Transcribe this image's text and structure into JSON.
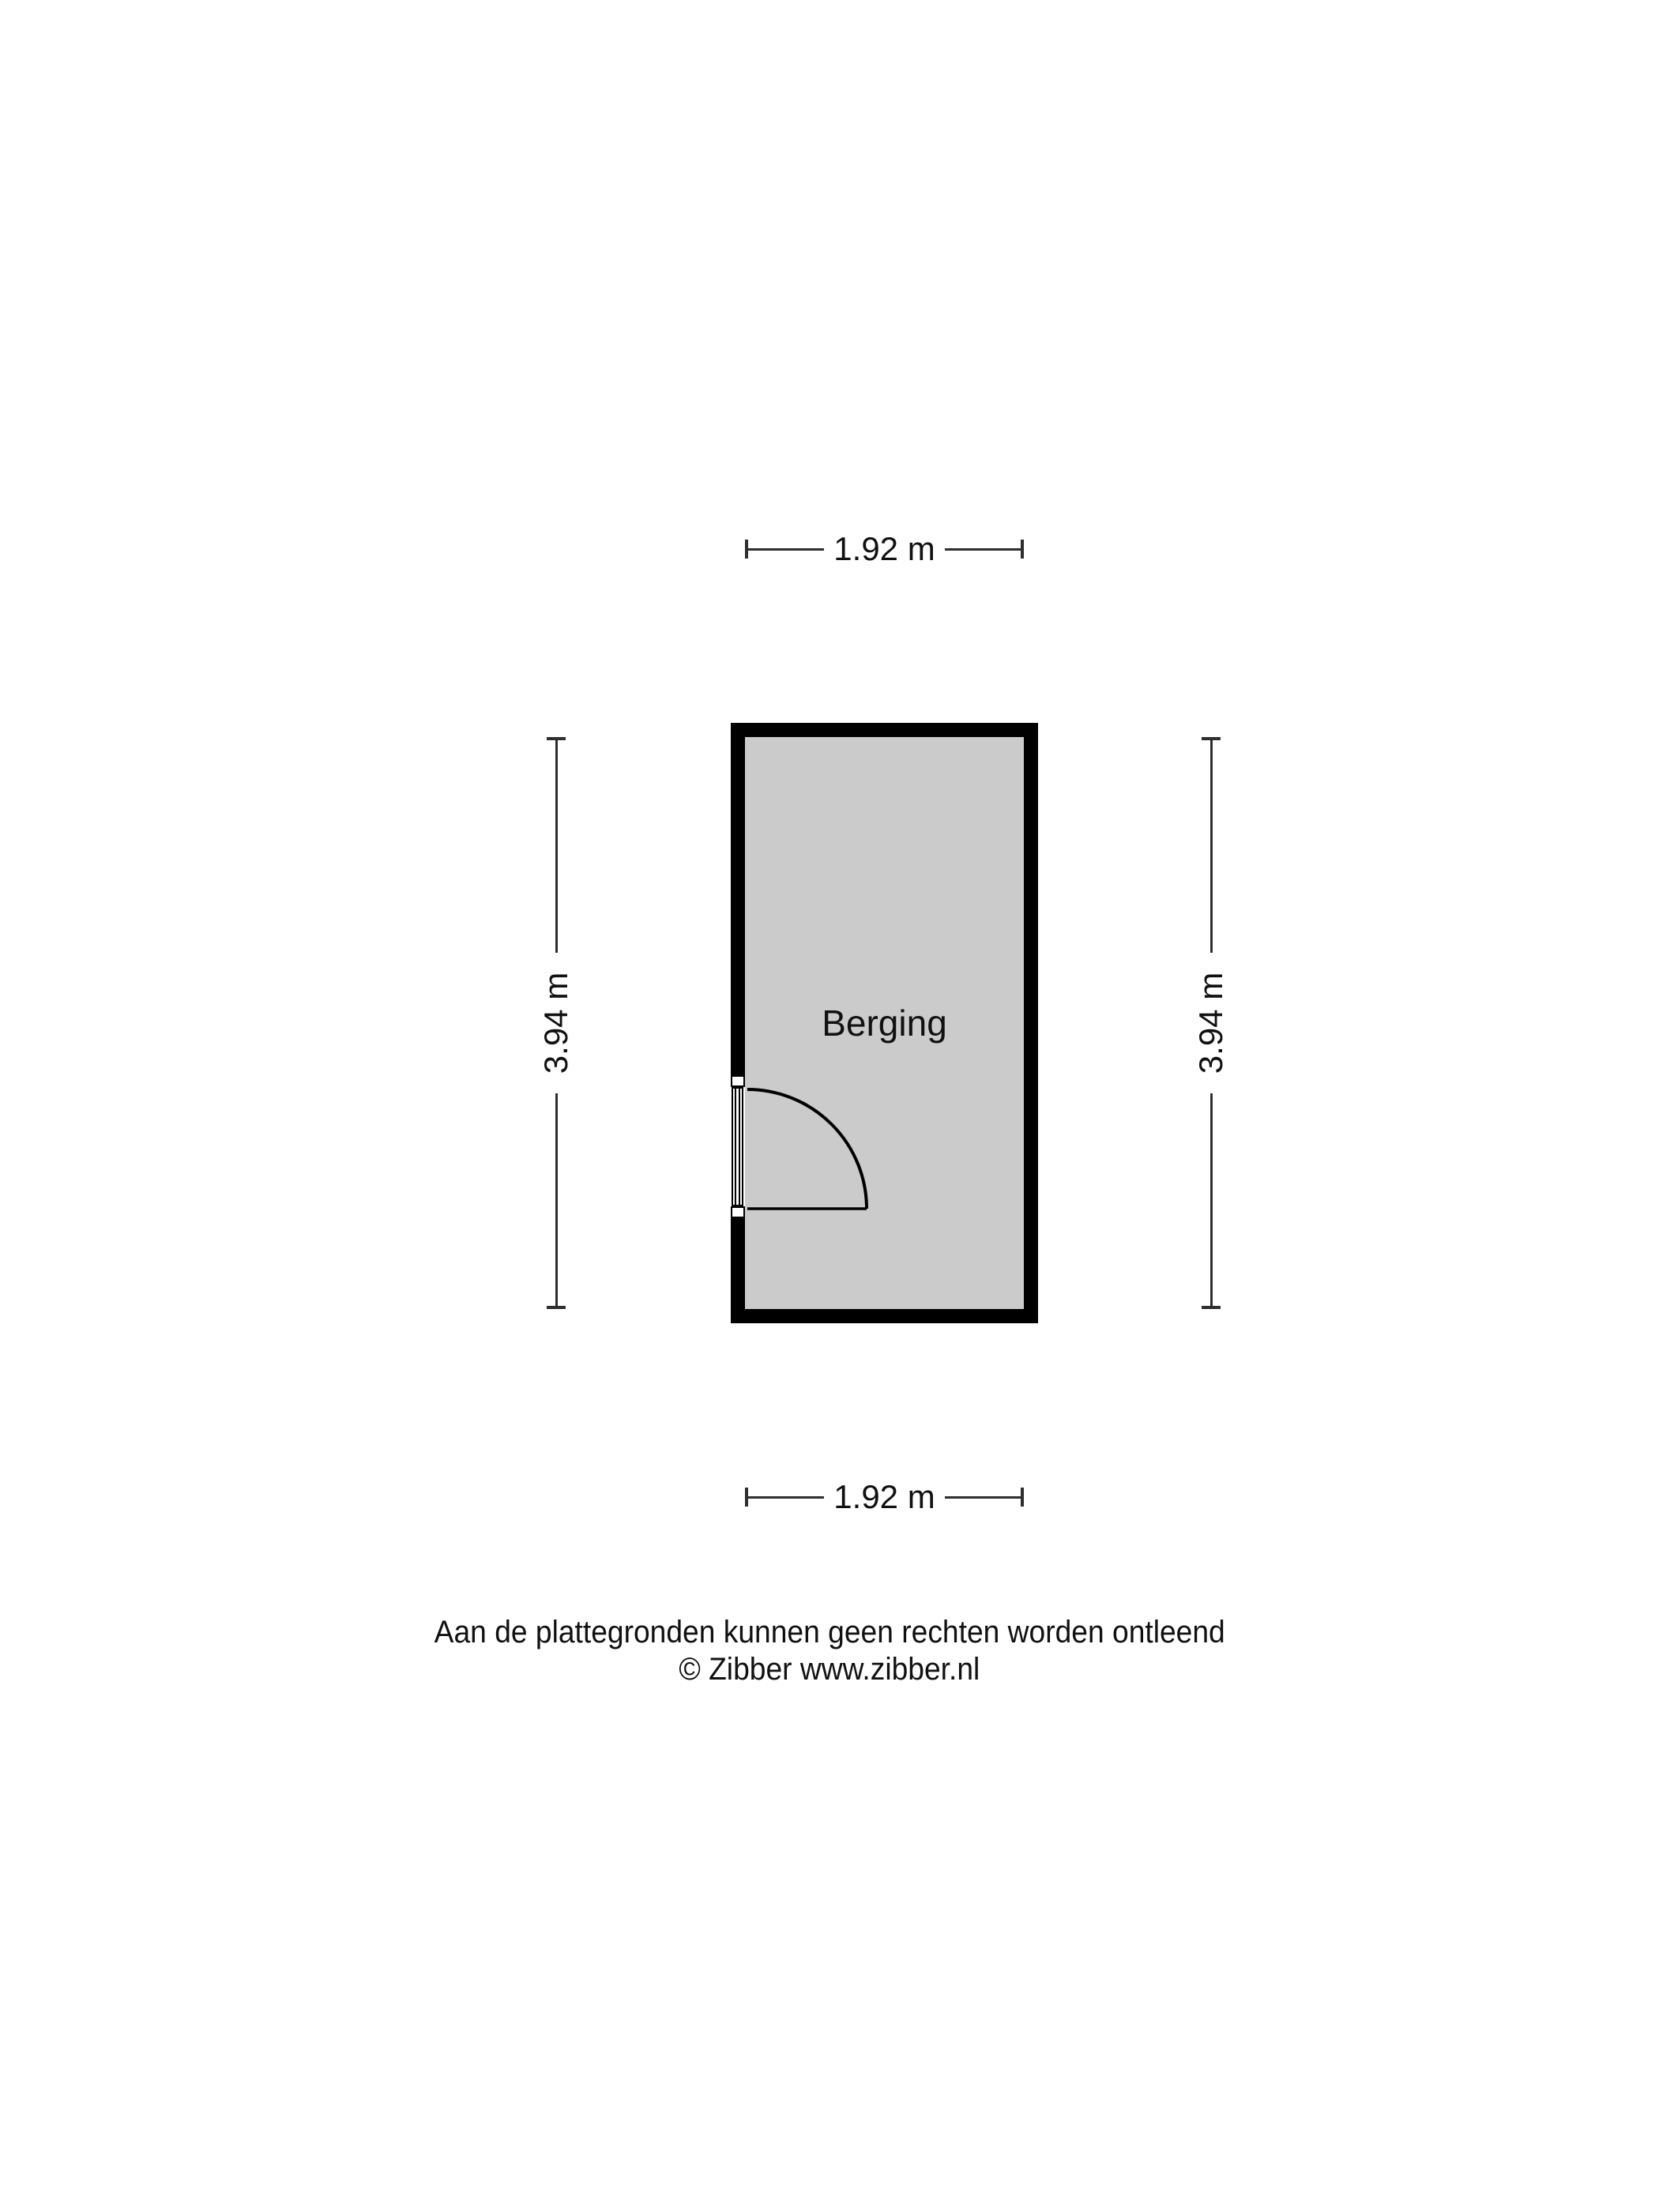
{
  "room": {
    "name": "Berging"
  },
  "dimensions": {
    "top": {
      "label": "1.92 m"
    },
    "bottom": {
      "label": "1.92 m"
    },
    "left": {
      "label": "3.94 m"
    },
    "right": {
      "label": "3.94 m"
    }
  },
  "footer": {
    "disclaimer": "Aan de plattegronden kunnen geen rechten worden ontleend",
    "copyright": "© Zibber www.zibber.nl"
  },
  "theme": {
    "wall-color": "#000000",
    "floor-color": "#cbcbcb",
    "dim-line-color": "#2e2e2e",
    "text-color": "#111111",
    "bg-color": "#ffffff"
  }
}
